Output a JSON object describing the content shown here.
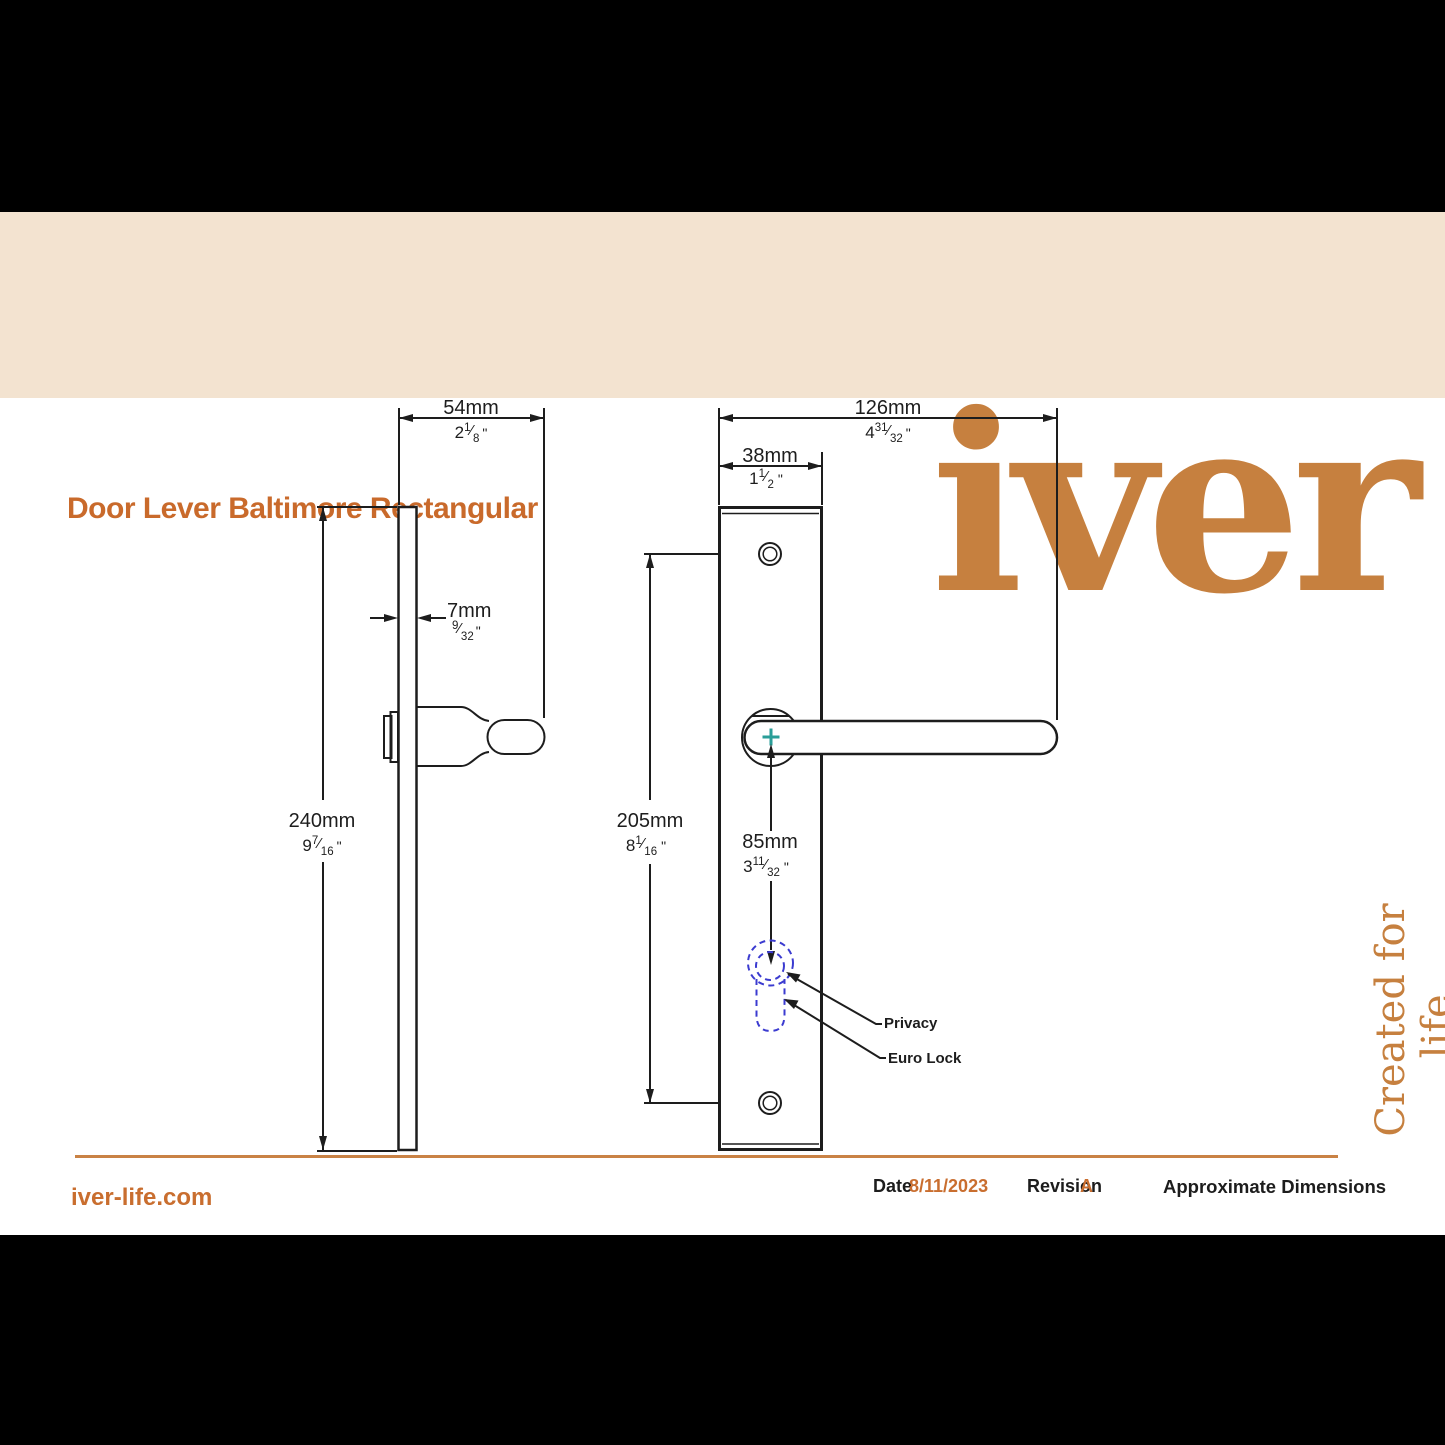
{
  "header": {
    "title": "Door Lever Baltimore Rectangular",
    "logo_text": "iver"
  },
  "tagline": "Created for life.",
  "colors": {
    "brand_orange": "#c96a2b",
    "logo_orange": "#c6803f",
    "cream_band": "#f3e3d0",
    "line_black": "#1d1d1d",
    "lock_dash_blue": "#3b3bd0",
    "centre_cross_teal": "#2a9e98"
  },
  "drawing": {
    "inch_mark": "\"",
    "annotations": {
      "privacy": "Privacy",
      "euro_lock": "Euro Lock"
    },
    "dimensions": {
      "backplate_depth": {
        "mm": "54mm",
        "whole": "2",
        "num": "1",
        "den": "8"
      },
      "plate_thickness": {
        "mm": "7mm",
        "whole": "",
        "num": "9",
        "den": "32"
      },
      "backplate_height": {
        "mm": "240mm",
        "whole": "9",
        "num": "7",
        "den": "16"
      },
      "lever_length": {
        "mm": "126mm",
        "whole": "4",
        "num": "31",
        "den": "32"
      },
      "plate_width": {
        "mm": "38mm",
        "whole": "1",
        "num": "1",
        "den": "2"
      },
      "screw_centres": {
        "mm": "205mm",
        "whole": "8",
        "num": "1",
        "den": "16"
      },
      "centre_to_lock": {
        "mm": "85mm",
        "whole": "3",
        "num": "11",
        "den": "32"
      }
    }
  },
  "footer": {
    "website": "iver-life.com",
    "date_label": "Date",
    "date_value": "8/11/2023",
    "revision_label": "Revision",
    "revision_value": "A",
    "note": "Approximate Dimensions"
  }
}
